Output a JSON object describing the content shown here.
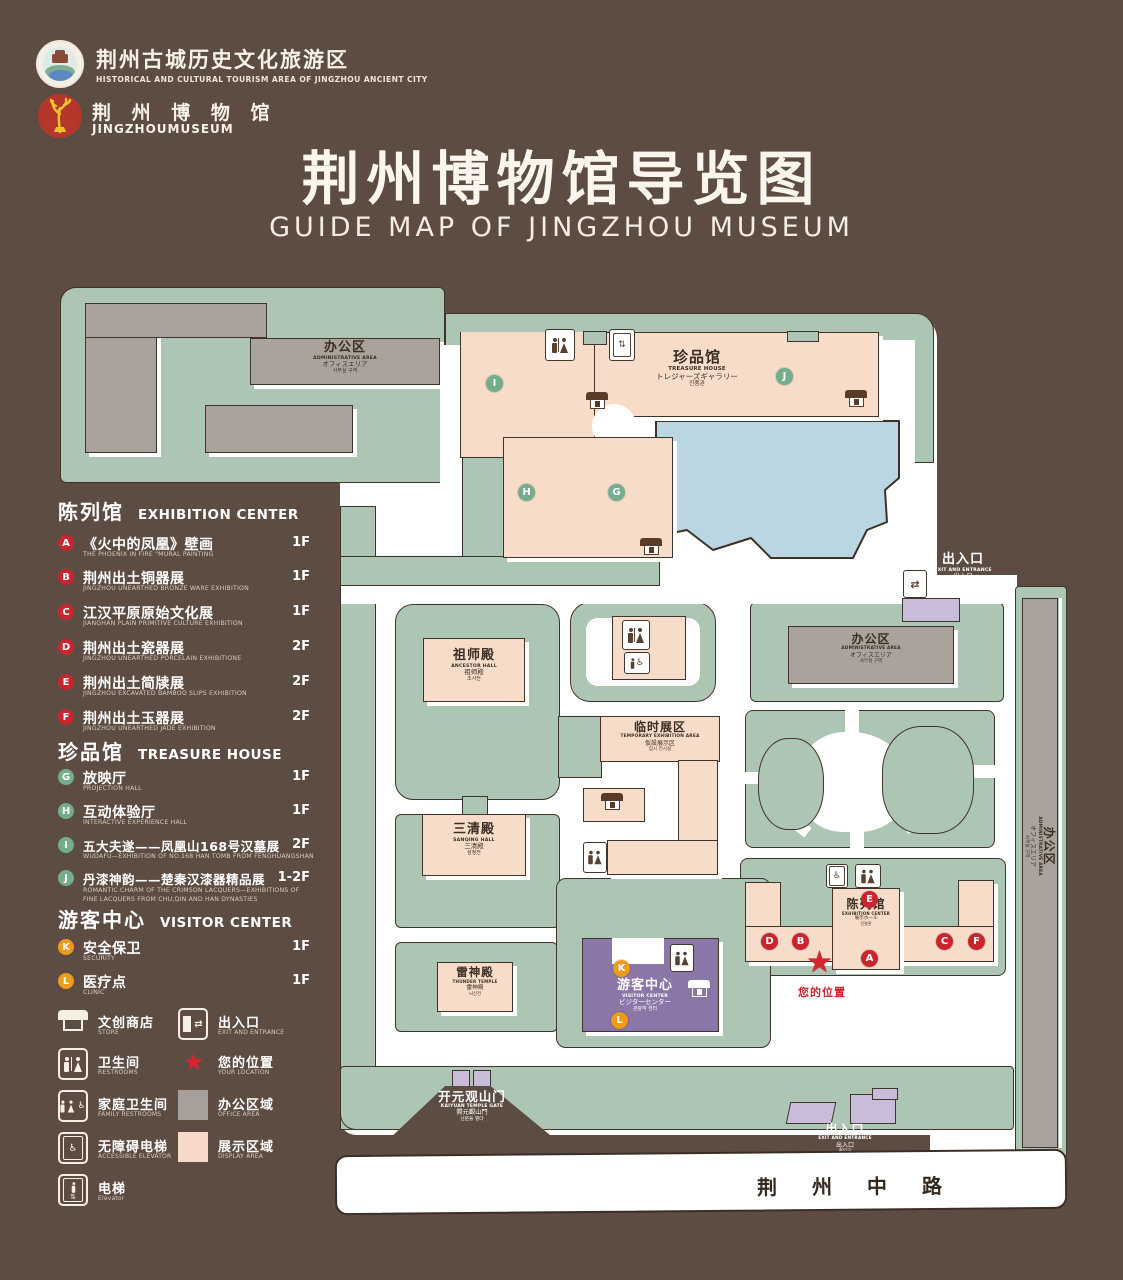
{
  "title": {
    "zh": "荆州博物馆导览图",
    "en": "GUIDE MAP OF JINGZHOU MUSEUM"
  },
  "logos": {
    "tourism": {
      "zh": "荆州古城历史文化旅游区",
      "en": "HISTORICAL AND CULTURAL TOURISM AREA OF JINGZHOU ANCIENT CITY"
    },
    "museum": {
      "zh": "荆 州 博 物 馆",
      "en": "JINGZHOUMUSEUM"
    }
  },
  "legend": {
    "sections": [
      {
        "zh": "陈列馆",
        "en": "EXHIBITION CENTER",
        "items": [
          {
            "letter": "A",
            "zh": "《火中的凤凰》壁画",
            "en": "THE PHOENIX IN FIRE \"MURAL PAINTING",
            "floor": "1F"
          },
          {
            "letter": "B",
            "zh": "荆州出土铜器展",
            "en": "JINGZHOU UNEARTHED BRONZE WARE EXHIBITION",
            "floor": "1F"
          },
          {
            "letter": "C",
            "zh": "江汉平原原始文化展",
            "en": "JIANGHAN PLAIN PRIMITIVE CULTURE EXHIBITION",
            "floor": "1F"
          },
          {
            "letter": "D",
            "zh": "荆州出土瓷器展",
            "en": "JINGZHOU UNEARTHED PORCELAIN EXHIBITIONE",
            "floor": "2F"
          },
          {
            "letter": "E",
            "zh": "荆州出土简牍展",
            "en": "JINGZHOU EXCAVATED BAMBOO SLIPS EXHIBITION",
            "floor": "2F"
          },
          {
            "letter": "F",
            "zh": "荆州出土玉器展",
            "en": "JINGZHOU UNEARTHED JADE EXHIBITION",
            "floor": "2F"
          }
        ]
      },
      {
        "zh": "珍品馆",
        "en": "TREASURE HOUSE",
        "items": [
          {
            "letter": "G",
            "zh": "放映厅",
            "en": "PROJECTION HALL",
            "floor": "1F"
          },
          {
            "letter": "H",
            "zh": "互动体验厅",
            "en": "INTERACTIVE EXPERIENCE HALL",
            "floor": "1F"
          },
          {
            "letter": "I",
            "zh": "五大夫遂——凤凰山168号汉墓展",
            "en": "WUDAFU—EXHIBITION OF NO.168 HAN TOMB FROM FENGHUANGSHAN",
            "floor": "2F"
          },
          {
            "letter": "J",
            "zh": "丹漆神韵——楚秦汉漆器精品展",
            "en": "ROMANTIC CHARM OF THE CRIMSON LACQUERS—EXHIBITIONS OF FINE LACQUERS FROM CHU,QIN AND HAN DYNASTIES",
            "floor": "1-2F"
          }
        ]
      },
      {
        "zh": "游客中心",
        "en": "VISITOR CENTER",
        "items": [
          {
            "letter": "K",
            "zh": "安全保卫",
            "en": "SECURITY",
            "floor": "1F"
          },
          {
            "letter": "L",
            "zh": "医疗点",
            "en": "CLINIC",
            "floor": "1F"
          }
        ]
      }
    ],
    "symbols": [
      {
        "zh": "文创商店",
        "en": "STORE"
      },
      {
        "zh": "出入口",
        "en": "EXIT AND ENTRANCE"
      },
      {
        "zh": "卫生间",
        "en": "RESTROOMS"
      },
      {
        "zh": "您的位置",
        "en": "YOUR LOCATION"
      },
      {
        "zh": "家庭卫生间",
        "en": "FAMILY RESTROOMS"
      },
      {
        "zh": "办公区域",
        "en": "OFFICE AREA"
      },
      {
        "zh": "无障碍电梯",
        "en": "ACCESSIBLE ELEVATOR"
      },
      {
        "zh": "展示区域",
        "en": "DISPLAY AREA"
      },
      {
        "zh": "电梯",
        "en": "Elevator"
      }
    ]
  },
  "map": {
    "admin": {
      "zh": "办公区",
      "en": "ADMINISTRATIVE AREA",
      "ja": "オフィスエリア",
      "ko": "사무실 구역"
    },
    "treasure": {
      "zh": "珍品馆",
      "en": "TREASURE HOUSE",
      "ja": "トレジャーズギャラリー",
      "ko": "진품관"
    },
    "ancestor": {
      "zh": "祖师殿",
      "en": "ANCESTOR HALL",
      "ja": "祖师殿",
      "ko": "조사전"
    },
    "temp": {
      "zh": "临时展区",
      "en": "TEMPORARY EXHIBITION AREA",
      "ja": "仮設展示区",
      "ko": "임시 전시실"
    },
    "sanqing": {
      "zh": "三清殿",
      "en": "SANQING HALL",
      "ja": "三清殿",
      "ko": "삼청전"
    },
    "thunder": {
      "zh": "雷神殿",
      "en": "THUNDER TEMPLE",
      "ja": "雷神殿",
      "ko": "뇌신전"
    },
    "visitor": {
      "zh": "游客中心",
      "en": "VISITOR CENTER",
      "ja": "ビジターセンター",
      "ko": "관광객 센터"
    },
    "exhibition": {
      "zh": "陈列馆",
      "en": "EXHIBITION CENTER",
      "ja": "展示ホール",
      "ko": "진열관"
    },
    "gate": {
      "zh": "开元观山门",
      "en": "KAIYUAN TEMPLE GATE",
      "ja": "開元觀山門",
      "ko": "산문을 열다"
    },
    "exit": {
      "zh": "出入口",
      "en": "EXIT AND ENTRANCE",
      "ja": "出入口",
      "ko": "출입구"
    },
    "road": "荆 州 中 路",
    "your_location": "您的位置",
    "markers": {
      "A": "A",
      "B": "B",
      "C": "C",
      "D": "D",
      "E": "E",
      "F": "F",
      "G": "G",
      "H": "H",
      "I": "I",
      "J": "J",
      "K": "K",
      "L": "L"
    }
  },
  "colors": {
    "background": "#5d4c41",
    "lawn": "#adc5b3",
    "building": "#f8dcca",
    "office": "#aaa39c",
    "water": "#b9d6e2",
    "visitor_purple": "#8b77a7",
    "marker_red": "#c9252e",
    "marker_green": "#74ad8c",
    "marker_orange": "#f09a1b",
    "star_red": "#d6252e"
  }
}
